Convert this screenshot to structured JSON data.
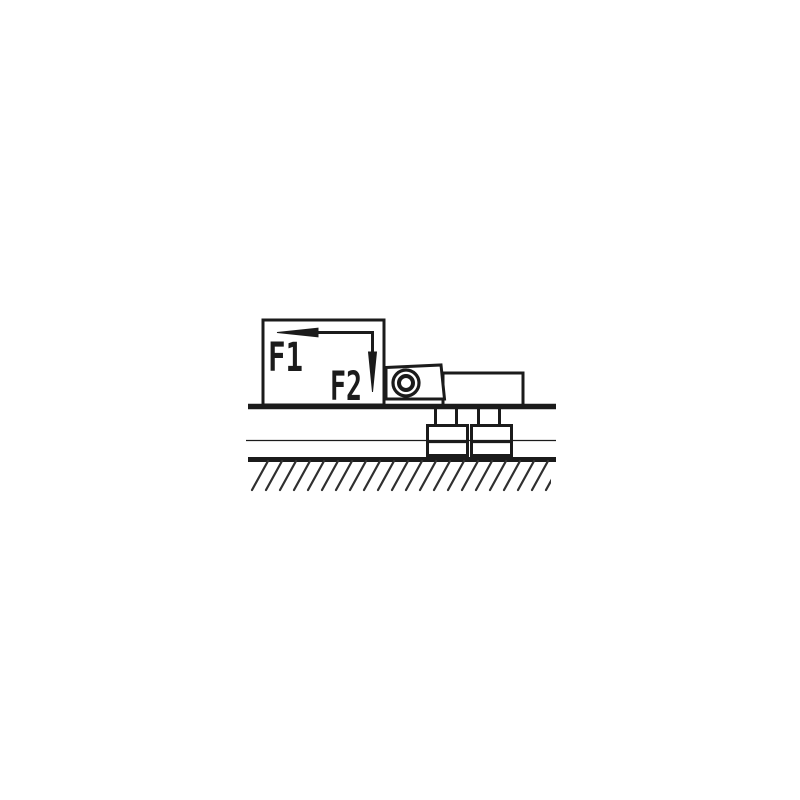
{
  "diagram": {
    "type": "technical-drawing",
    "description": "Clamping fixture schematic: a box loaded by horizontal force F1 and vertical force F2 pressing a pivot clamp and bar onto a slotted machine table above hatched ground",
    "labels": {
      "f1": "F1",
      "f2": "F2"
    },
    "colors": {
      "ink": "#1b1b1b",
      "background": "#ffffff",
      "hatch": "#2f2f2f"
    }
  }
}
